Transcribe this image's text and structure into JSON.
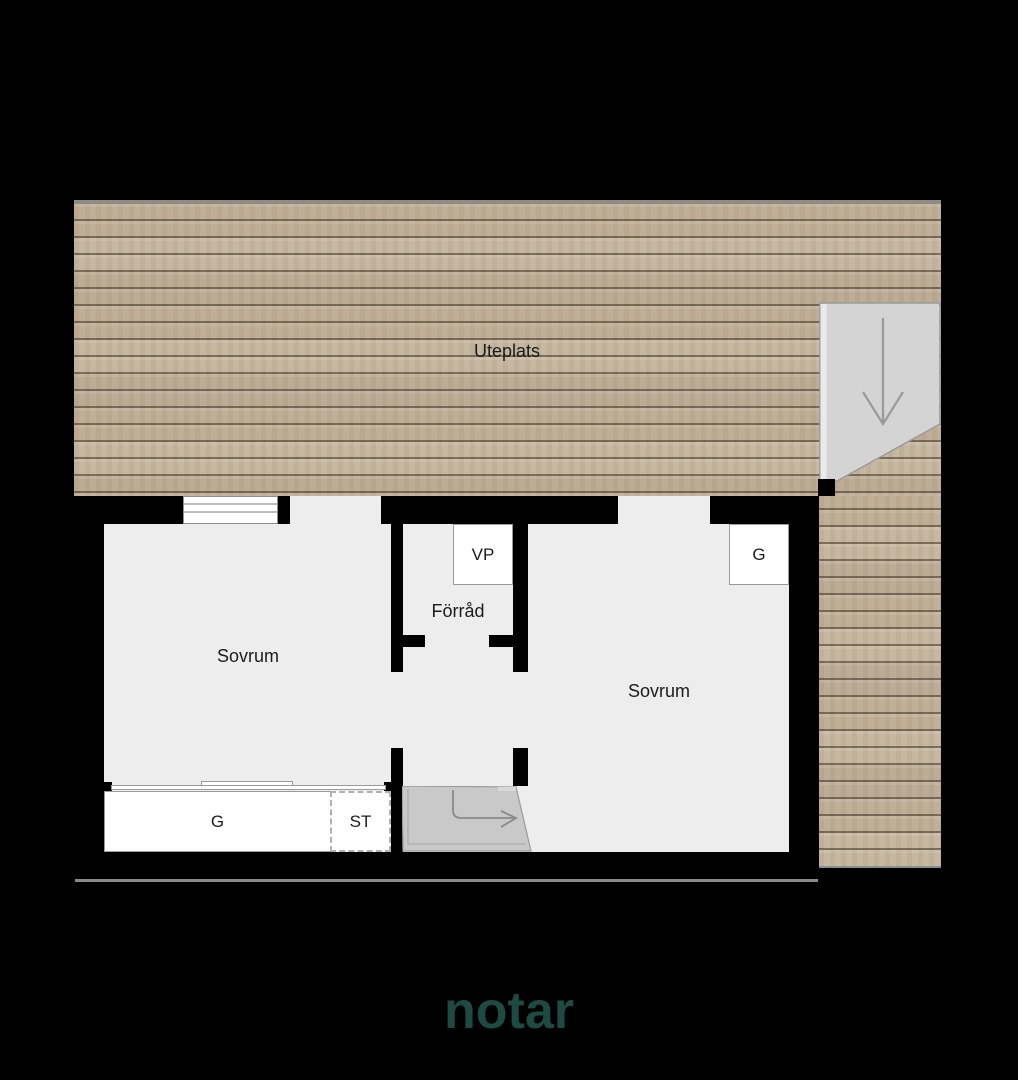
{
  "background_color": "#000000",
  "floorplan": {
    "deck": {
      "label": "Uteplats"
    },
    "rooms": [
      {
        "id": "bedroom-left",
        "label": "Sovrum"
      },
      {
        "id": "bedroom-right",
        "label": "Sovrum"
      },
      {
        "id": "storage",
        "label": "Förråd"
      }
    ],
    "fixtures": [
      {
        "id": "water-heater",
        "label": "VP"
      },
      {
        "id": "wardrobe-right",
        "label": "G"
      },
      {
        "id": "wardrobe-left",
        "label": "G"
      },
      {
        "id": "cleaning-closet",
        "label": "ST"
      }
    ],
    "icons": {
      "stairs_down_arrow": "straight arrow pointing down on deck stair landing",
      "entrance_arrow": "curved arrow pointing right on entrance ramp"
    },
    "colors": {
      "wood": "#c2b199",
      "plank_line": "#8b8070",
      "floor": "#ededed",
      "wall": "#000000",
      "stair_landing": "#d4d4d4",
      "entrance_ramp": "#c9c9c9",
      "arrow": "#9a9a9a",
      "label_text": "#1b1b1b"
    }
  },
  "branding": {
    "logo": "notar",
    "logo_color": "#1d4a43"
  }
}
